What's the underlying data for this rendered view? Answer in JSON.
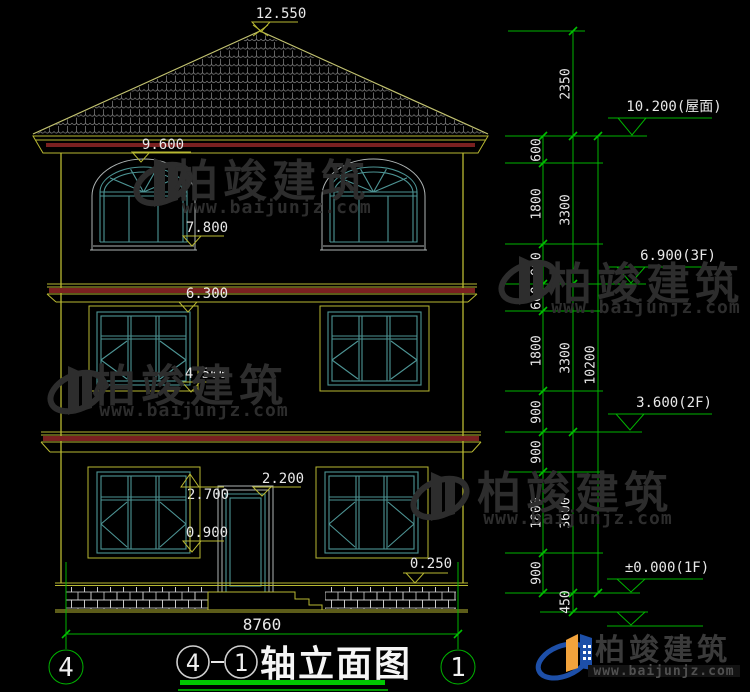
{
  "levels_left": {
    "ridge": "12.550",
    "eave": "9.600",
    "f3_sill": "7.800",
    "f2_head": "6.300",
    "f2_sill": "4.500",
    "f1_head": "2.700",
    "door_head": "2.200",
    "f1_sill": "0.900",
    "plinth_top": "0.250"
  },
  "levels_right": {
    "roof": "10.200(屋面)",
    "f3": "6.900(3F)",
    "f2": "3.600(2F)",
    "f1": "±0.000(1F)"
  },
  "dim_chain_inner": [
    "600",
    "1800",
    "900",
    "600",
    "1800",
    "900",
    "900",
    "1800",
    "900"
  ],
  "dim_chain_mid": [
    "2350",
    "3300",
    "3300",
    "3600",
    "450"
  ],
  "dim_total_height": "10200",
  "dim_overall_width": "8760",
  "axis_bubbles": {
    "left": "4",
    "right": "1"
  },
  "title": {
    "axis_a": "4",
    "separator": "-",
    "axis_b": "1",
    "label": "轴立面图"
  },
  "watermark": {
    "name": "柏竣建筑",
    "url": "www.baijunjz.com"
  },
  "logo": {
    "name": "柏竣建筑",
    "url": "www.baijunjz.com"
  },
  "colors": {
    "building_outline": "#b8b832",
    "window_frame": "#4d9494",
    "cornice_accent": "#7a2020",
    "dimension_green": "#00b400",
    "text": "#e8e8e8",
    "title_underline": "#00c800",
    "logo_blue": "#1d4fa8",
    "logo_orange": "#f2a33c",
    "watermark_gray": "#2d2d2d",
    "roof_tile": "#787878",
    "brick": "#d0d0d0"
  }
}
